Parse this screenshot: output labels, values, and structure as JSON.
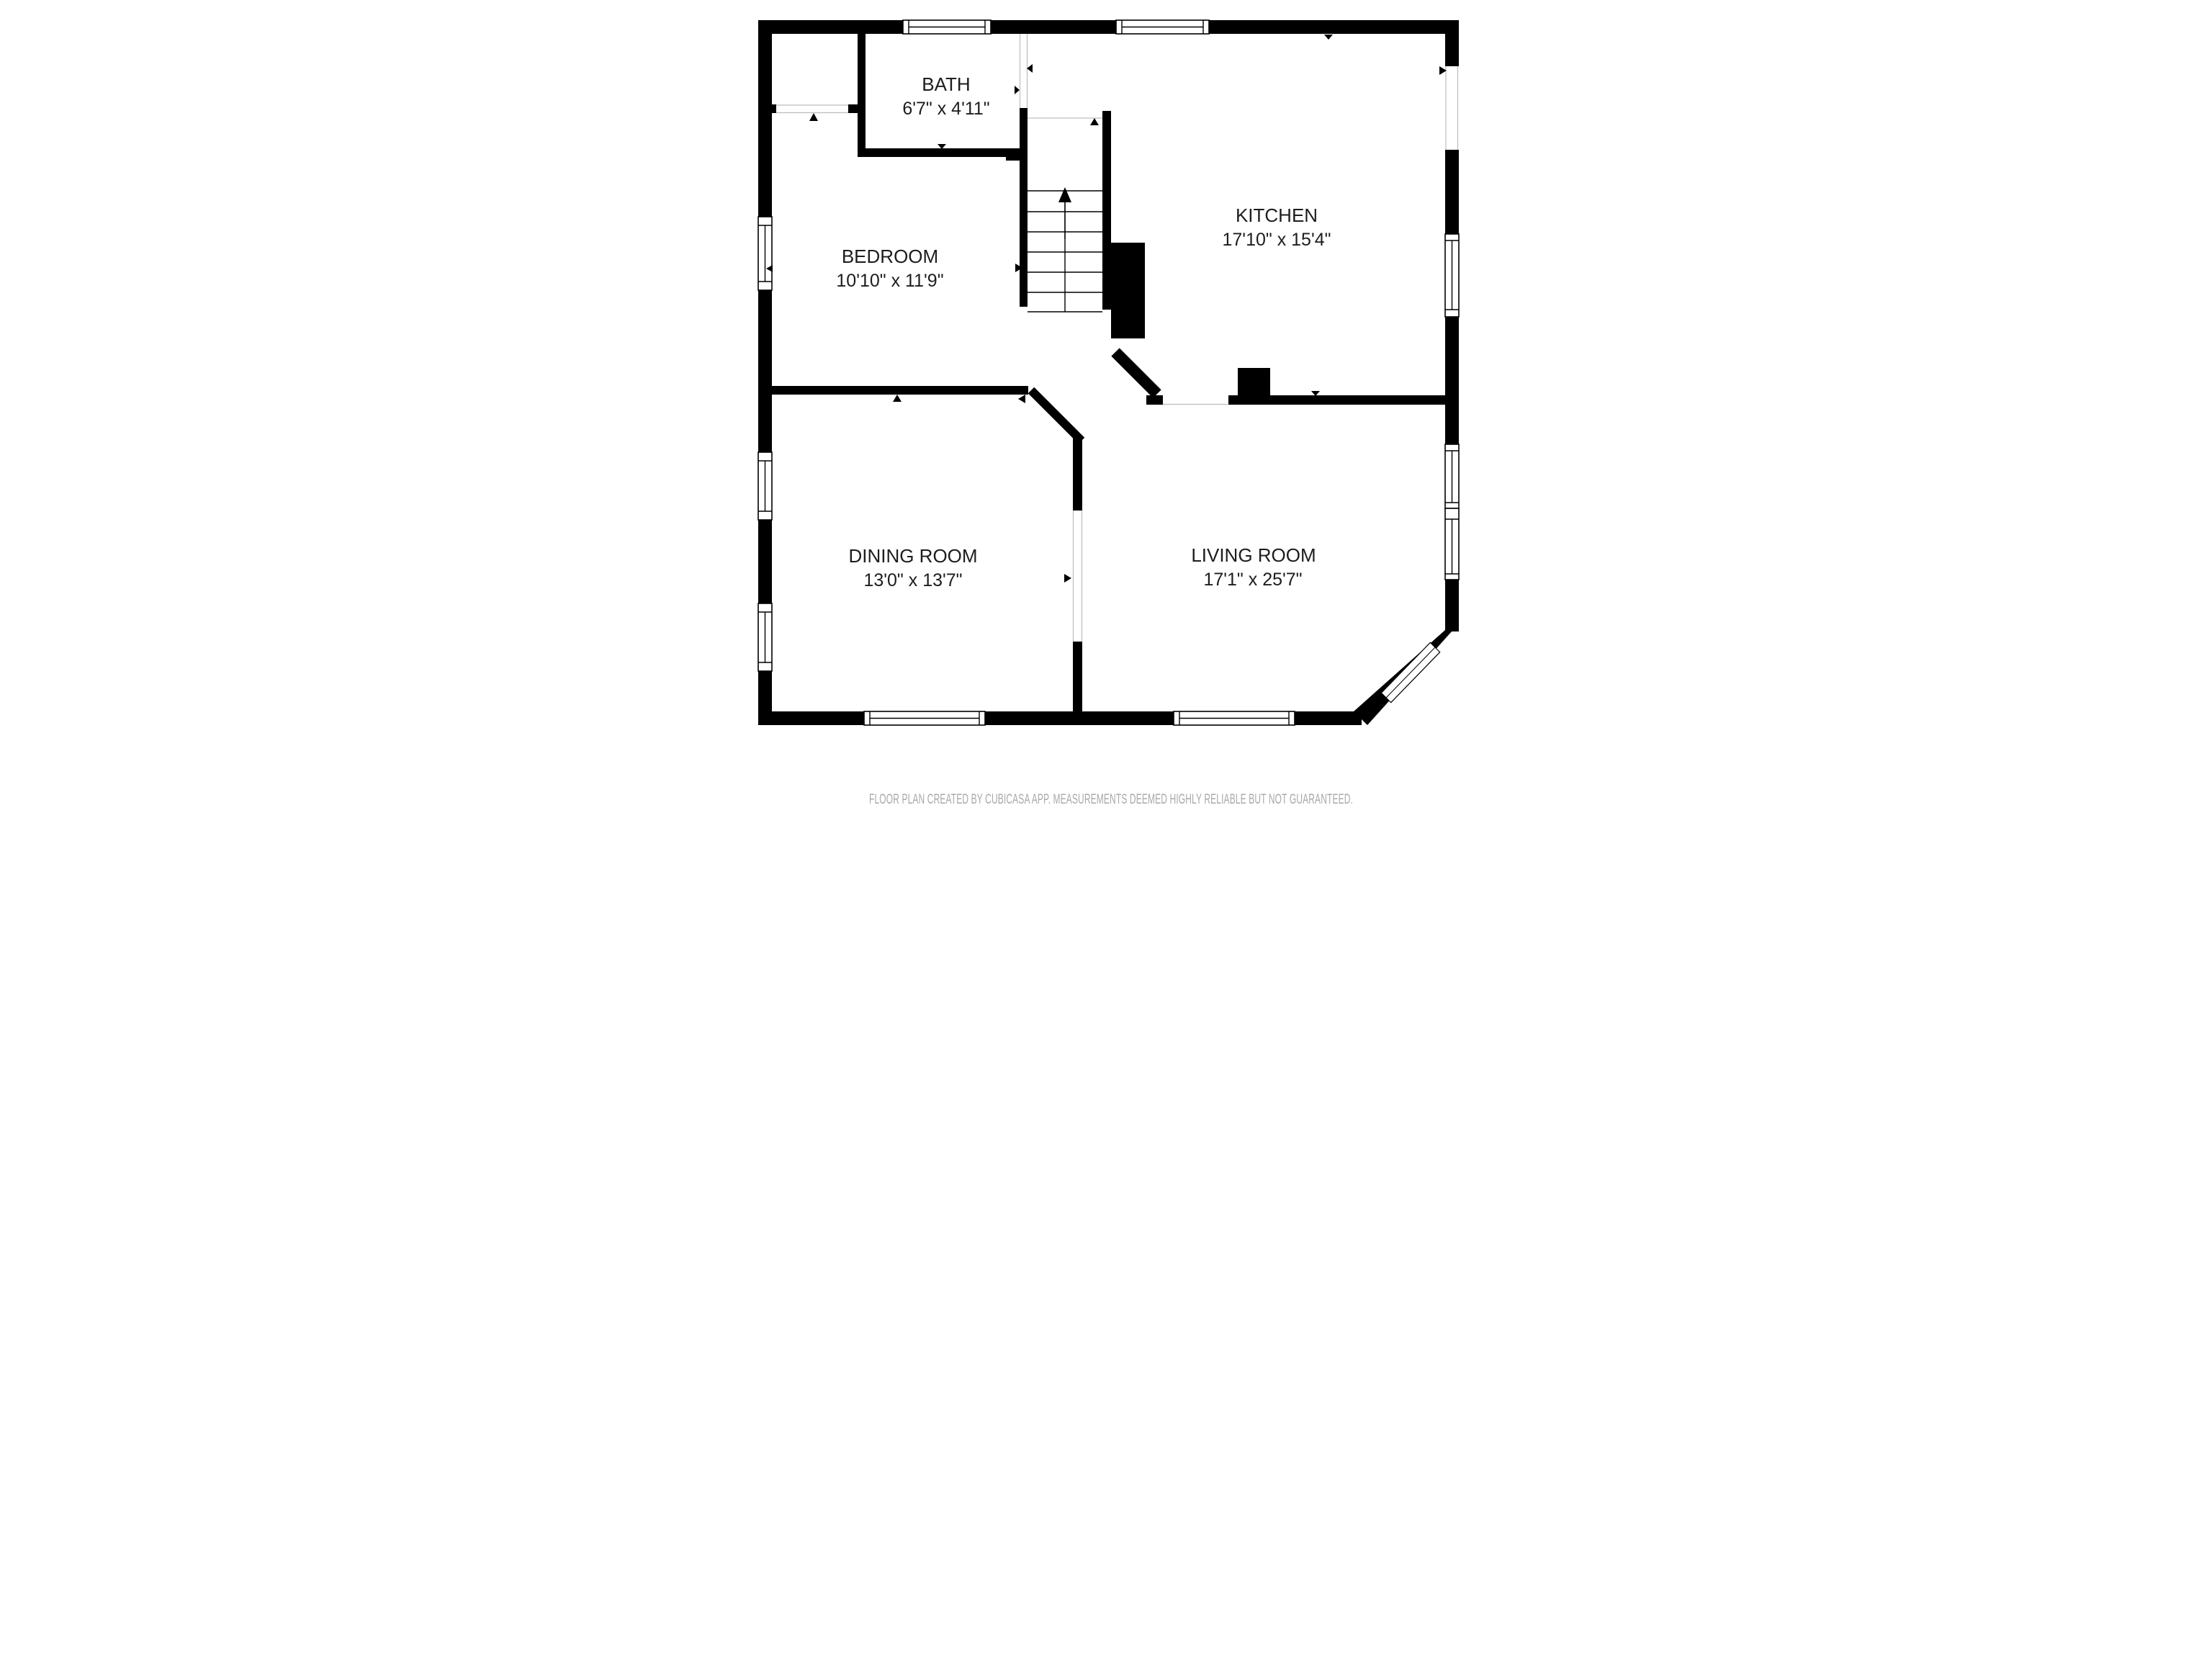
{
  "rooms": [
    {
      "id": "bath",
      "name": "BATH",
      "dims": "6'7\" x 4'11\""
    },
    {
      "id": "bedroom",
      "name": "BEDROOM",
      "dims": "10'10\" x 11'9\""
    },
    {
      "id": "kitchen",
      "name": "KITCHEN",
      "dims": "17'10\" x 15'4\""
    },
    {
      "id": "dining",
      "name": "DINING ROOM",
      "dims": "13'0\" x 13'7\""
    },
    {
      "id": "living",
      "name": "LIVING ROOM",
      "dims": "17'1\" x 25'7\""
    }
  ],
  "stairs": {
    "tread_lines": 7,
    "direction": "up"
  },
  "footer": {
    "text": "FLOOR PLAN CREATED BY CUBICASA APP. MEASUREMENTS DEEMED HIGHLY RELIABLE BUT NOT GUARANTEED."
  },
  "colors": {
    "background": "#ffffff",
    "walls": "#000000",
    "room_label": "#1d1d1d",
    "footer_text": "#a8a8a8",
    "opening_line": "#bdbdbd"
  }
}
